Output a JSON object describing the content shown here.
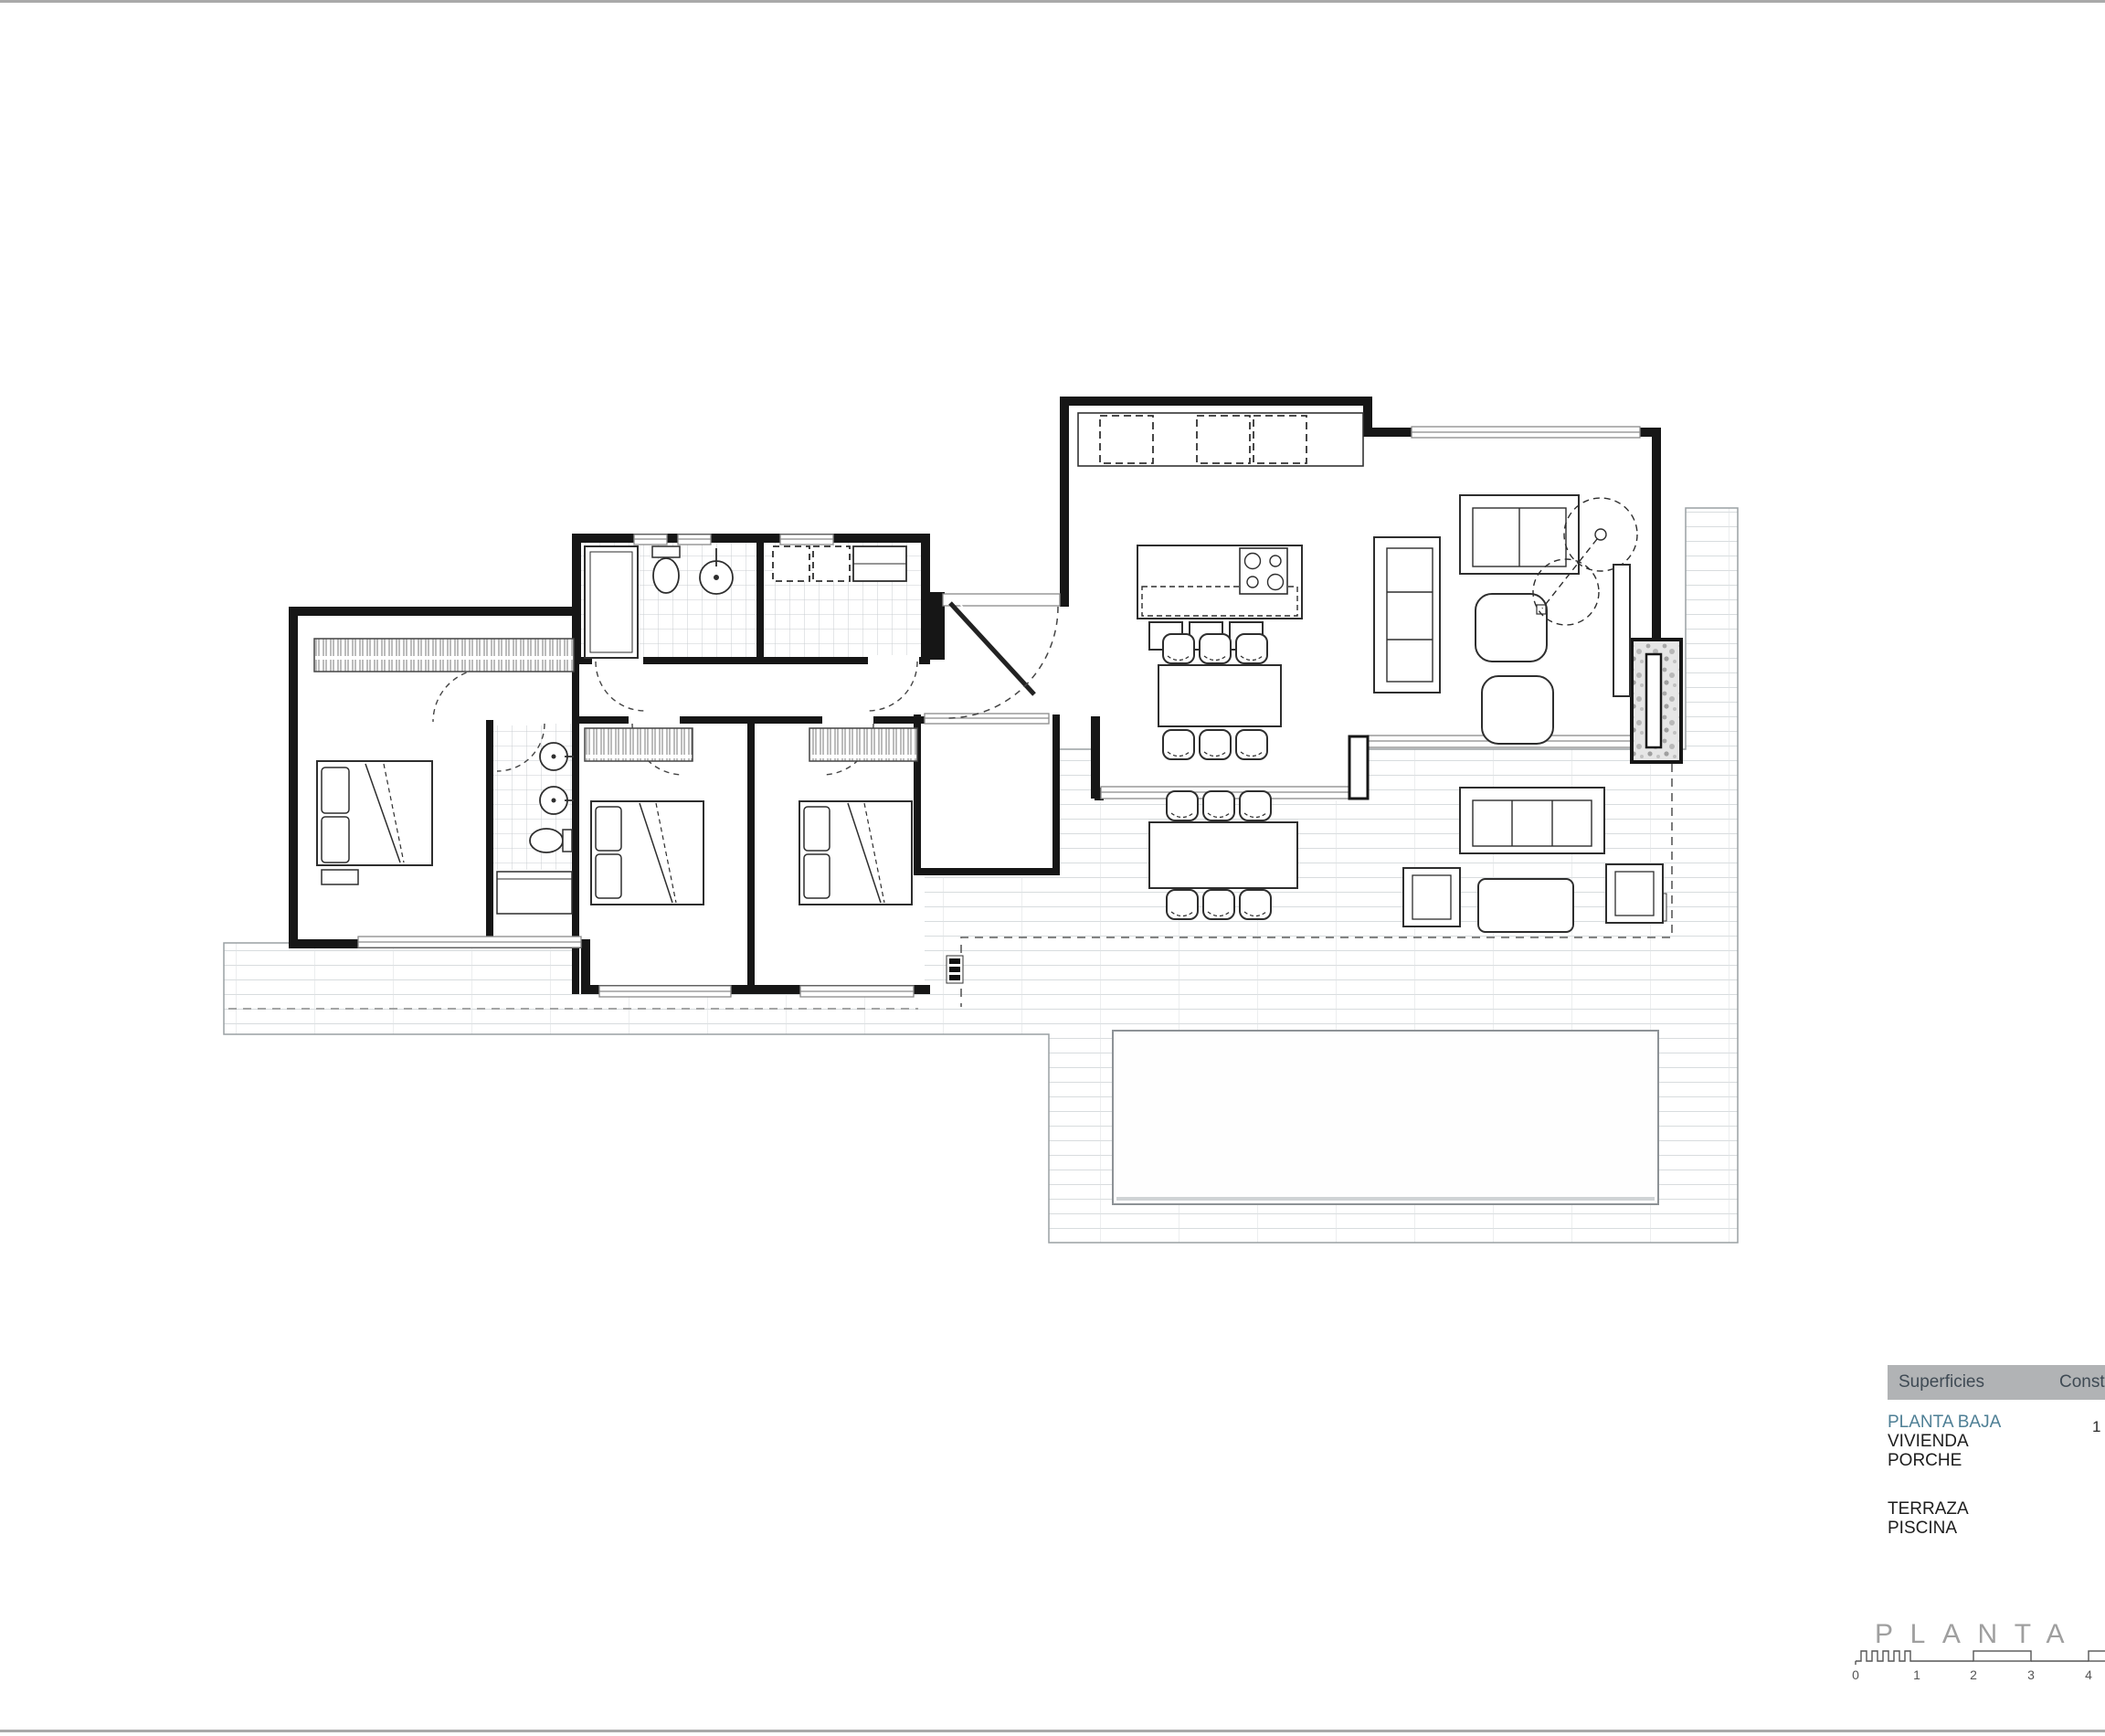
{
  "page": {
    "background": "#ffffff",
    "border_color": "#a9a9a9"
  },
  "legend": {
    "header": {
      "col1": "Superficies",
      "col2": "Const",
      "bg": "#b1b3b5",
      "text_color": "#3f4a54"
    },
    "rows": [
      {
        "label": "PLANTA BAJA",
        "color": "#4e7f95"
      },
      {
        "label": "VIVIENDA",
        "color": "#1d1d1d"
      },
      {
        "label": "PORCHE",
        "color": "#1d1d1d"
      },
      {
        "label": "TERRAZA",
        "color": "#1d1d1d"
      },
      {
        "label": "PISCINA",
        "color": "#1d1d1d"
      }
    ],
    "partial_value": "1"
  },
  "plan_title": {
    "text": "PLANTA BAJA",
    "color": "#9f9f9f"
  },
  "scale_bar": {
    "labels": [
      "0",
      "1",
      "2",
      "3",
      "4"
    ]
  },
  "drawing": {
    "wall_color": "#161616",
    "furniture_color": "#2e2e2e",
    "tile_line_color": "#ccd1d4",
    "pool_border": "#8d9296"
  }
}
